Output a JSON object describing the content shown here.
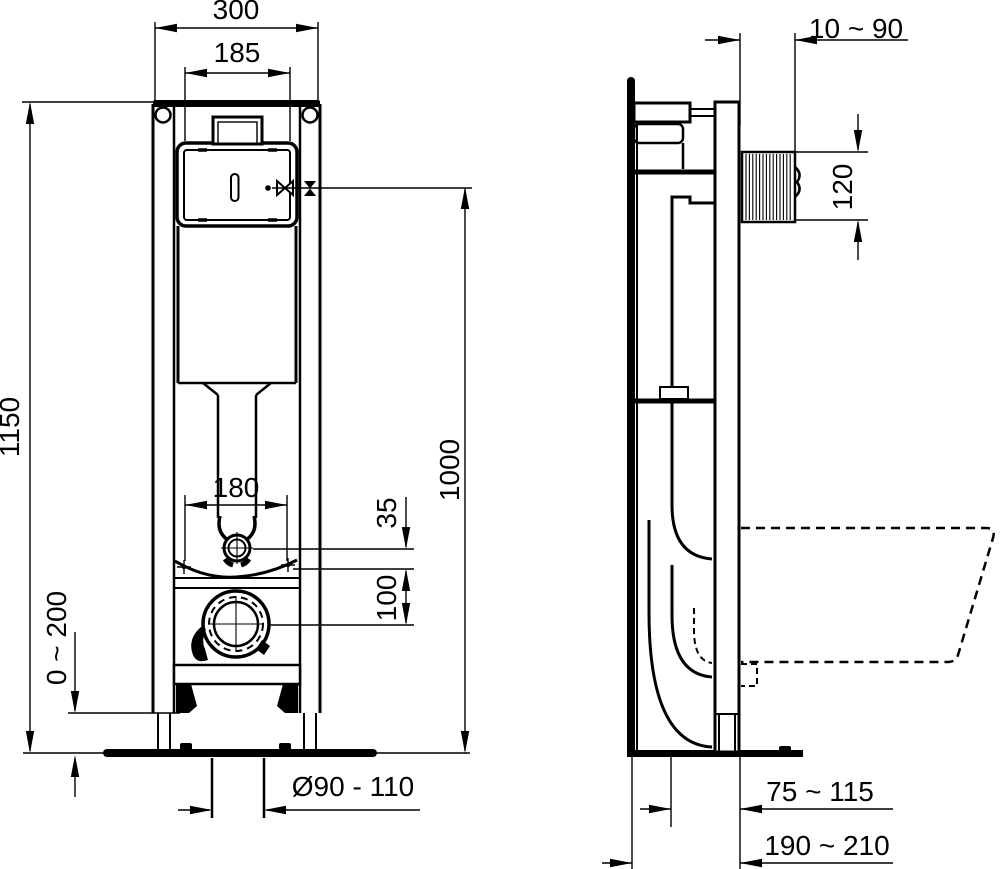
{
  "page": {
    "background": "#ffffff",
    "ink": "#000000"
  },
  "front_view": {
    "dims": {
      "frame_width": "300",
      "cistern_width": "185",
      "frame_height": "1150",
      "flush_line_height": "1000",
      "pan_bolt_spacing": "180",
      "inlet_gap": "35",
      "drain_drop": "100",
      "foot_adjustment": "0 ~ 200",
      "drain_diameter": "Ø90 - 110"
    }
  },
  "side_view": {
    "dims": {
      "wall_offset": "10 ~ 90",
      "flush_bend_height": "120",
      "drain_to_front": "75 ~ 115",
      "drain_to_wall": "190 ~ 210"
    }
  }
}
